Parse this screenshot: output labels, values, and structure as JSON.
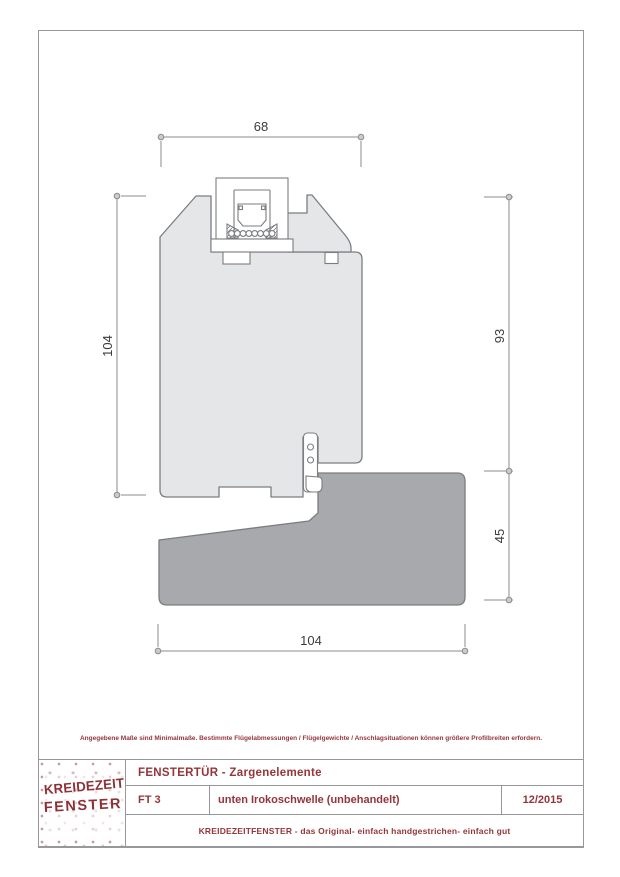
{
  "note": "Angegebene Maße sind Minimalmaße. Bestimmte Flügelabmessungen / Flügelgewichte / Anschlagsituationen können größere Profilbreiten erfordern.",
  "logo": {
    "line1": "KREIDEZEIT",
    "line2": "FENSTER"
  },
  "title_block": {
    "title": "FENSTERTÜR - Zargenelemente",
    "code": "FT 3",
    "description": "unten Irokoschwelle (unbehandelt)",
    "date": "12/2015",
    "tagline": "KREIDEZEITFENSTER - das Original- einfach handgestrichen- einfach gut"
  },
  "drawing": {
    "type": "technical-cross-section",
    "subject": "door sill profile with iroko threshold",
    "dimensions": {
      "top_width": "68",
      "left_height": "104",
      "right_upper": "93",
      "right_lower": "45",
      "bottom_width": "104"
    },
    "colors": {
      "frame_profile": "#e5e6e7",
      "threshold_profile": "#a7a9ac",
      "outline": "#7b7d81",
      "dimension_line": "#8a8c8e",
      "dimension_text": "#3b3b3c",
      "brand_red": "#963539"
    }
  }
}
